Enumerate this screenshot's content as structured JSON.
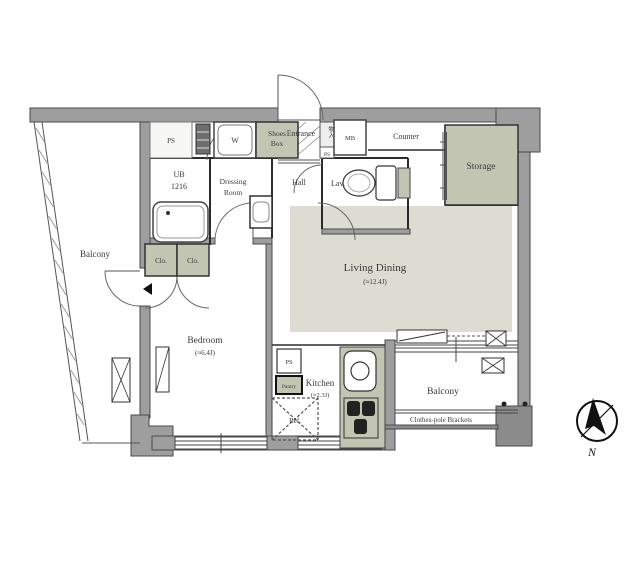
{
  "colors": {
    "wall": "#9e9e9e",
    "wall_dark": "#8b8b8b",
    "shade": "#c3c5b3",
    "floor": "#dcdcd3",
    "line": "#333333"
  },
  "rooms": {
    "balcony_left": {
      "label": "Balcony"
    },
    "balcony_bottom": {
      "label": "Balcony"
    },
    "bedroom": {
      "label": "Bedroom",
      "size": "(≈6.4J)"
    },
    "living_dining": {
      "label": "Living Dining",
      "size": "(≈12.4J)"
    },
    "kitchen": {
      "label": "Kitchen",
      "size": "(≈2.3J)"
    },
    "storage": {
      "label": "Storage"
    },
    "hall": {
      "label": "Hall"
    },
    "lavatory": {
      "label": "Lav."
    },
    "entrance": {
      "label": "Entrance"
    },
    "counter": {
      "label": "Counter"
    },
    "unit_bath": {
      "line1": "UB",
      "line2": "1216"
    },
    "dressing_room": {
      "line1": "Dressing",
      "line2": "Room"
    },
    "shoes_box": {
      "line1": "Shoes",
      "line2": "Box"
    }
  },
  "fixtures": {
    "washer": "W",
    "meter_box": "MB",
    "pipe_space": "PS",
    "pantry": "Pantry",
    "refrigerator": "Ref.",
    "closet": "Clo.",
    "hall_closet": "物入"
  },
  "annotations": {
    "clothes_pole": "Clothes-pole Brackets",
    "compass_north": "N"
  }
}
